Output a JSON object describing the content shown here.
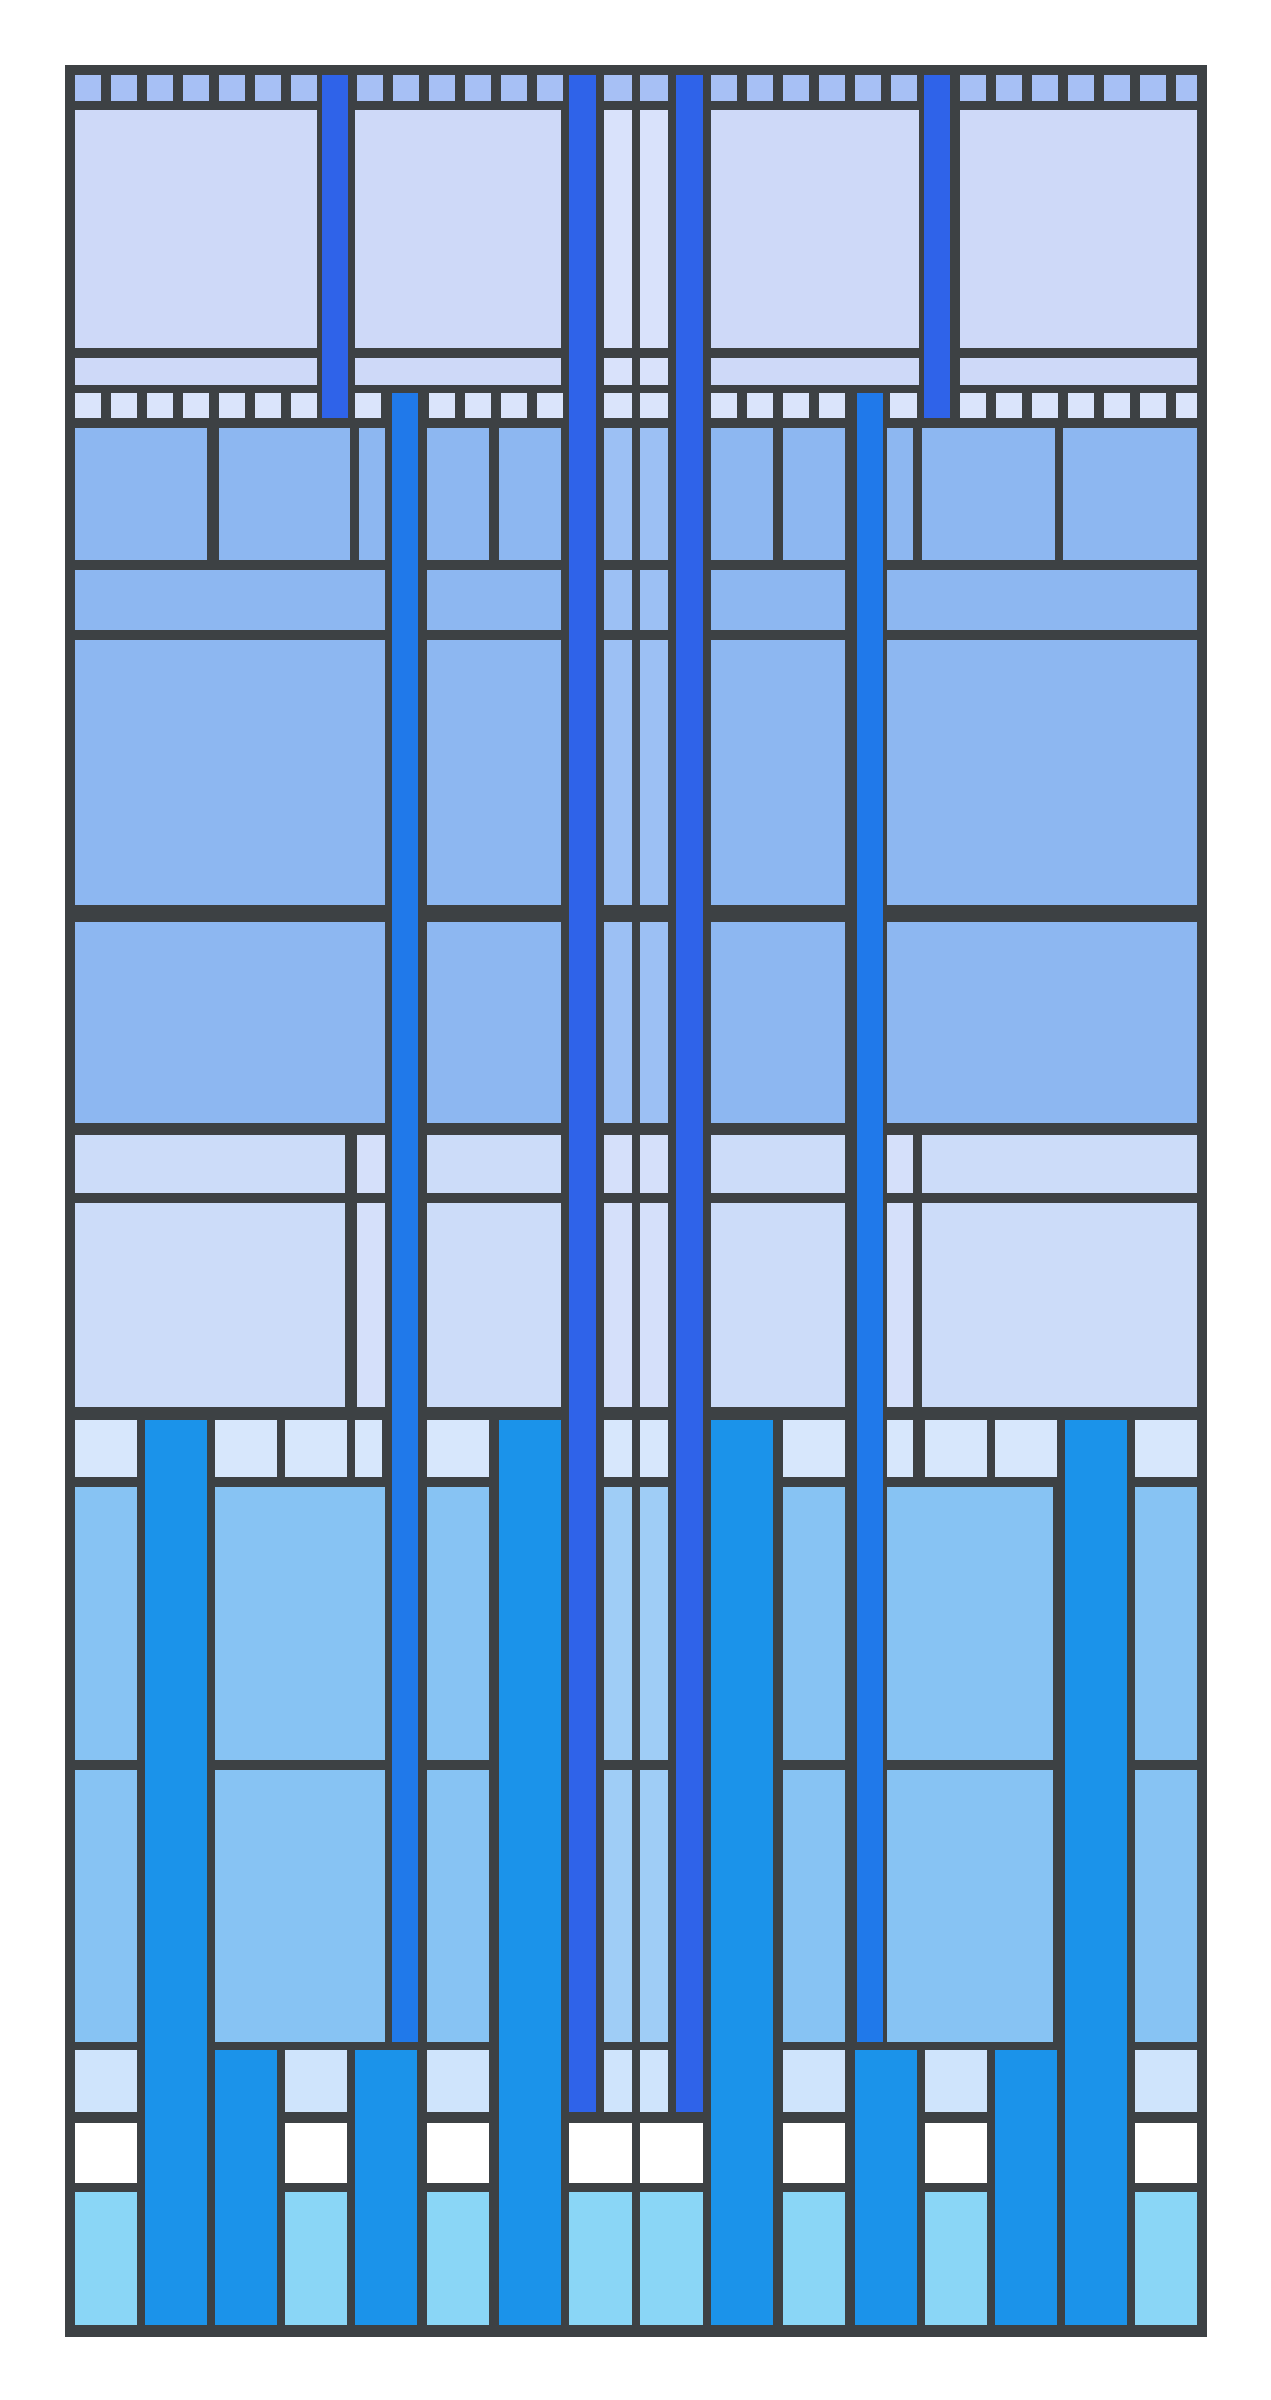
{
  "artwork": {
    "title": "abstract-blue-stained-glass-grid",
    "canvas": {
      "width": 1271,
      "height": 2400,
      "background": "#ffffff"
    },
    "palette": {
      "frame": "#3d4144",
      "sq_top": "#a7c0f5",
      "lavender": "#ced9f8",
      "lav_light": "#d9e2fb",
      "sq_mid": "#dae4fb",
      "medium": "#8db7f1",
      "med_light": "#9cc0f4",
      "light_low": "#ccdcf9",
      "light_low2": "#d5e0fa",
      "sq_low": "#d7e7fc",
      "sky": "#87c3f3",
      "sky_light": "#9fcdf6",
      "pale": "#cfe4fc",
      "white": "#ffffff",
      "cyan": "#8ad6f6",
      "azure": "#1b93ea",
      "azure_deep": "#2079ea",
      "royal": "#2f63e9"
    },
    "frame": {
      "x": 65,
      "y": 65,
      "w": 1142,
      "h": 2272,
      "color": "frame"
    },
    "bands": [
      {
        "name": "top-square-strip",
        "y": 75,
        "h": 26,
        "color": "sq_top",
        "cells": [
          [
            75,
            26
          ],
          [
            111,
            26
          ],
          [
            147,
            26
          ],
          [
            183,
            26
          ],
          [
            219,
            26
          ],
          [
            255,
            26
          ],
          [
            291,
            26
          ],
          [
            357,
            26
          ],
          [
            393,
            26
          ],
          [
            429,
            26
          ],
          [
            465,
            26
          ],
          [
            501,
            26
          ],
          [
            537,
            26
          ],
          [
            604,
            28
          ],
          [
            640,
            28
          ],
          [
            711,
            26
          ],
          [
            747,
            26
          ],
          [
            783,
            26
          ],
          [
            819,
            26
          ],
          [
            855,
            26
          ],
          [
            891,
            26
          ],
          [
            960,
            26
          ],
          [
            996,
            26
          ],
          [
            1032,
            26
          ],
          [
            1068,
            26
          ],
          [
            1104,
            26
          ],
          [
            1140,
            26
          ],
          [
            1176,
            21
          ]
        ]
      },
      {
        "name": "tall-lavender-panels",
        "y": 110,
        "h": 238,
        "color": "lavender",
        "cells": [
          [
            75,
            242
          ],
          [
            355,
            206
          ],
          [
            604,
            28,
            "lav_light"
          ],
          [
            640,
            28,
            "lav_light"
          ],
          [
            711,
            208
          ],
          [
            960,
            237
          ]
        ]
      },
      {
        "name": "thin-lavender-band",
        "y": 358,
        "h": 27,
        "color": "lavender",
        "cells": [
          [
            75,
            242
          ],
          [
            355,
            206
          ],
          [
            604,
            28,
            "lav_light"
          ],
          [
            640,
            28,
            "lav_light"
          ],
          [
            711,
            208
          ],
          [
            960,
            237
          ]
        ]
      },
      {
        "name": "mid-square-strip",
        "y": 393,
        "h": 25,
        "color": "sq_mid",
        "cells": [
          [
            75,
            26
          ],
          [
            111,
            26
          ],
          [
            147,
            26
          ],
          [
            183,
            26
          ],
          [
            219,
            26
          ],
          [
            255,
            26
          ],
          [
            291,
            26
          ],
          [
            355,
            26
          ],
          [
            429,
            26
          ],
          [
            465,
            26
          ],
          [
            501,
            26
          ],
          [
            537,
            26
          ],
          [
            604,
            28
          ],
          [
            640,
            28
          ],
          [
            711,
            26
          ],
          [
            747,
            26
          ],
          [
            783,
            26
          ],
          [
            819,
            26
          ],
          [
            890,
            27
          ],
          [
            960,
            26
          ],
          [
            996,
            26
          ],
          [
            1032,
            26
          ],
          [
            1068,
            26
          ],
          [
            1104,
            26
          ],
          [
            1140,
            26
          ],
          [
            1176,
            21
          ]
        ]
      },
      {
        "name": "medium-band-1",
        "y": 428,
        "h": 132,
        "color": "medium",
        "cells": [
          [
            75,
            132
          ],
          [
            219,
            131
          ],
          [
            359,
            26
          ],
          [
            427,
            62
          ],
          [
            499,
            62
          ],
          [
            604,
            28,
            "med_light"
          ],
          [
            640,
            28,
            "med_light"
          ],
          [
            711,
            62
          ],
          [
            783,
            62
          ],
          [
            887,
            26
          ],
          [
            922,
            133
          ],
          [
            1063,
            134
          ]
        ]
      },
      {
        "name": "medium-band-thin",
        "y": 570,
        "h": 60,
        "color": "medium",
        "cells": [
          [
            75,
            310
          ],
          [
            427,
            134
          ],
          [
            604,
            28,
            "med_light"
          ],
          [
            640,
            28,
            "med_light"
          ],
          [
            711,
            134
          ],
          [
            887,
            310
          ]
        ]
      },
      {
        "name": "medium-band-2",
        "y": 640,
        "h": 265,
        "color": "medium",
        "cells": [
          [
            75,
            310
          ],
          [
            427,
            134
          ],
          [
            604,
            28,
            "med_light"
          ],
          [
            640,
            28,
            "med_light"
          ],
          [
            711,
            134
          ],
          [
            887,
            310
          ]
        ]
      },
      {
        "name": "medium-band-3",
        "y": 922,
        "h": 201,
        "color": "medium",
        "cells": [
          [
            75,
            310
          ],
          [
            427,
            134
          ],
          [
            604,
            28,
            "med_light"
          ],
          [
            640,
            28,
            "med_light"
          ],
          [
            711,
            134
          ],
          [
            887,
            310
          ]
        ]
      },
      {
        "name": "light-band-thin",
        "y": 1135,
        "h": 58,
        "color": "light_low",
        "cells": [
          [
            75,
            270
          ],
          [
            357,
            28,
            "light_low2"
          ],
          [
            427,
            134
          ],
          [
            604,
            28,
            "light_low2"
          ],
          [
            640,
            28,
            "light_low2"
          ],
          [
            711,
            134
          ],
          [
            887,
            26,
            "light_low2"
          ],
          [
            922,
            275
          ]
        ]
      },
      {
        "name": "light-band-tall",
        "y": 1203,
        "h": 204,
        "color": "light_low",
        "cells": [
          [
            75,
            270
          ],
          [
            357,
            28,
            "light_low2"
          ],
          [
            427,
            134
          ],
          [
            604,
            28,
            "light_low2"
          ],
          [
            640,
            28,
            "light_low2"
          ],
          [
            711,
            134
          ],
          [
            887,
            26,
            "light_low2"
          ],
          [
            922,
            275
          ]
        ]
      },
      {
        "name": "low-square-strip",
        "y": 1420,
        "h": 57,
        "color": "sq_low",
        "cells": [
          [
            75,
            62
          ],
          [
            145,
            62,
            "azure"
          ],
          [
            215,
            62
          ],
          [
            285,
            62
          ],
          [
            355,
            27
          ],
          [
            427,
            62
          ],
          [
            499,
            62,
            "azure"
          ],
          [
            604,
            28
          ],
          [
            640,
            28
          ],
          [
            711,
            62,
            "azure"
          ],
          [
            783,
            62
          ],
          [
            887,
            26
          ],
          [
            925,
            62
          ],
          [
            995,
            62
          ],
          [
            1065,
            62,
            "azure"
          ],
          [
            1135,
            62
          ]
        ]
      },
      {
        "name": "sky-band-1",
        "y": 1487,
        "h": 273,
        "color": "sky",
        "cells": [
          [
            75,
            62
          ],
          [
            145,
            62,
            "azure"
          ],
          [
            215,
            170
          ],
          [
            427,
            62
          ],
          [
            499,
            62,
            "azure"
          ],
          [
            604,
            28,
            "sky_light"
          ],
          [
            640,
            28,
            "sky_light"
          ],
          [
            711,
            62,
            "azure"
          ],
          [
            783,
            62
          ],
          [
            887,
            166
          ],
          [
            1065,
            62,
            "azure"
          ],
          [
            1135,
            62
          ]
        ]
      },
      {
        "name": "sky-band-2",
        "y": 1770,
        "h": 272,
        "color": "sky",
        "cells": [
          [
            75,
            62
          ],
          [
            145,
            62,
            "azure"
          ],
          [
            215,
            170
          ],
          [
            427,
            62
          ],
          [
            499,
            62,
            "azure"
          ],
          [
            604,
            28,
            "sky_light"
          ],
          [
            640,
            28,
            "sky_light"
          ],
          [
            711,
            62,
            "azure"
          ],
          [
            783,
            62
          ],
          [
            887,
            166
          ],
          [
            1065,
            62,
            "azure"
          ],
          [
            1135,
            62
          ]
        ]
      },
      {
        "name": "pale-row",
        "y": 2050,
        "h": 62,
        "color": "pale",
        "cells": [
          [
            75,
            62
          ],
          [
            145,
            62,
            "azure"
          ],
          [
            215,
            62,
            "azure"
          ],
          [
            285,
            62
          ],
          [
            355,
            62,
            "azure"
          ],
          [
            427,
            62
          ],
          [
            499,
            62,
            "azure"
          ],
          [
            604,
            28
          ],
          [
            640,
            28
          ],
          [
            711,
            62,
            "azure"
          ],
          [
            783,
            62
          ],
          [
            855,
            62,
            "azure"
          ],
          [
            925,
            62
          ],
          [
            995,
            62,
            "azure"
          ],
          [
            1065,
            62,
            "azure"
          ],
          [
            1135,
            62
          ]
        ]
      },
      {
        "name": "white-row",
        "y": 2123,
        "h": 60,
        "color": "white",
        "cells": [
          [
            75,
            62
          ],
          [
            145,
            62,
            "azure"
          ],
          [
            215,
            62,
            "azure"
          ],
          [
            285,
            62
          ],
          [
            355,
            62,
            "azure"
          ],
          [
            427,
            62
          ],
          [
            499,
            62,
            "azure"
          ],
          [
            569,
            63
          ],
          [
            640,
            63
          ],
          [
            711,
            62,
            "azure"
          ],
          [
            783,
            62
          ],
          [
            855,
            62,
            "azure"
          ],
          [
            925,
            62
          ],
          [
            995,
            62,
            "azure"
          ],
          [
            1065,
            62,
            "azure"
          ],
          [
            1135,
            62
          ]
        ]
      },
      {
        "name": "cyan-row",
        "y": 2192,
        "h": 133,
        "color": "cyan",
        "cells": [
          [
            75,
            62
          ],
          [
            145,
            62,
            "azure"
          ],
          [
            215,
            62,
            "azure"
          ],
          [
            285,
            62
          ],
          [
            355,
            62,
            "azure"
          ],
          [
            427,
            62
          ],
          [
            499,
            62,
            "azure"
          ],
          [
            569,
            63
          ],
          [
            640,
            63
          ],
          [
            711,
            62,
            "azure"
          ],
          [
            783,
            62
          ],
          [
            855,
            62,
            "azure"
          ],
          [
            925,
            62
          ],
          [
            995,
            62,
            "azure"
          ],
          [
            1065,
            62,
            "azure"
          ],
          [
            1135,
            62
          ]
        ]
      }
    ],
    "bars": [
      {
        "name": "royal-stripe-left-short",
        "x": 322,
        "w": 26,
        "y": 75,
        "h": 343,
        "color": "royal"
      },
      {
        "name": "royal-stripe-right-short",
        "x": 924,
        "w": 26,
        "y": 75,
        "h": 343,
        "color": "royal"
      },
      {
        "name": "royal-stripe-center-left",
        "x": 569,
        "w": 27,
        "y": 75,
        "h": 2037,
        "color": "royal"
      },
      {
        "name": "royal-stripe-center-right",
        "x": 676,
        "w": 27,
        "y": 75,
        "h": 2037,
        "color": "royal"
      },
      {
        "name": "azure-stripe-left",
        "x": 392,
        "w": 26,
        "y": 393,
        "h": 1649,
        "color": "azure_deep"
      },
      {
        "name": "azure-stripe-right",
        "x": 857,
        "w": 26,
        "y": 393,
        "h": 1649,
        "color": "azure_deep"
      },
      {
        "name": "azure-column-2",
        "x": 145,
        "w": 62,
        "y": 1420,
        "h": 905,
        "color": "azure"
      },
      {
        "name": "azure-column-7",
        "x": 499,
        "w": 62,
        "y": 1420,
        "h": 905,
        "color": "azure"
      },
      {
        "name": "azure-column-12",
        "x": 711,
        "w": 62,
        "y": 1420,
        "h": 905,
        "color": "azure"
      },
      {
        "name": "azure-column-17",
        "x": 1065,
        "w": 62,
        "y": 1420,
        "h": 905,
        "color": "azure"
      },
      {
        "name": "azure-column-3",
        "x": 215,
        "w": 62,
        "y": 2050,
        "h": 275,
        "color": "azure"
      },
      {
        "name": "azure-column-5",
        "x": 355,
        "w": 62,
        "y": 2050,
        "h": 275,
        "color": "azure"
      },
      {
        "name": "azure-column-14",
        "x": 855,
        "w": 62,
        "y": 2050,
        "h": 275,
        "color": "azure"
      },
      {
        "name": "azure-column-16",
        "x": 995,
        "w": 62,
        "y": 2050,
        "h": 275,
        "color": "azure"
      }
    ]
  }
}
